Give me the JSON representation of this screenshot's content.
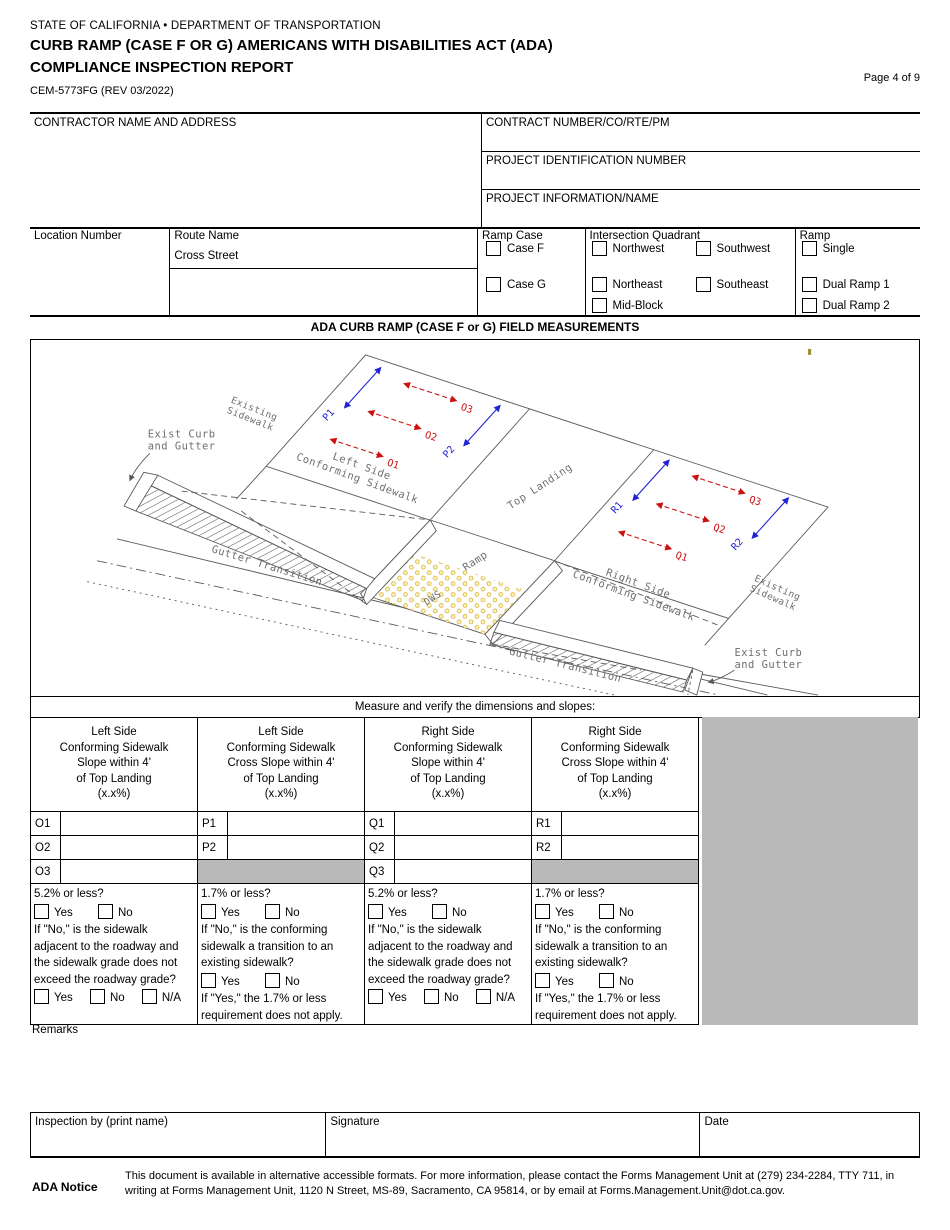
{
  "header": {
    "agency": "STATE OF CALIFORNIA • DEPARTMENT OF TRANSPORTATION",
    "title_line1": "CURB RAMP (CASE F OR G) AMERICANS WITH DISABILITIES ACT (ADA)",
    "title_line2": "COMPLIANCE INSPECTION REPORT",
    "form_number": "CEM-5773FG (REV 03/2022)",
    "page": "Page 4 of 9"
  },
  "info": {
    "contractor_label": "CONTRACTOR NAME AND ADDRESS",
    "contractor_value": "",
    "contract_label": "CONTRACT NUMBER/CO/RTE/PM",
    "contract_value": "",
    "project_id_label": "PROJECT IDENTIFICATION NUMBER",
    "project_id_value": "",
    "project_info_label": "PROJECT INFORMATION/NAME",
    "project_info_value": ""
  },
  "location": {
    "location_number_label": "Location Number",
    "route_name_label": "Route Name",
    "cross_street_label": "Cross Street",
    "ramp_case": {
      "label": "Ramp Case",
      "options": [
        {
          "label": "Case F",
          "checked": false
        },
        {
          "label": "Case G",
          "checked": false
        }
      ]
    },
    "quadrant": {
      "label": "Intersection Quadrant",
      "options": [
        {
          "label": "Northwest",
          "checked": false
        },
        {
          "label": "Southwest",
          "checked": false
        },
        {
          "label": "Northeast",
          "checked": false
        },
        {
          "label": "Southeast",
          "checked": false
        },
        {
          "label": "Mid-Block",
          "checked": false
        }
      ]
    },
    "ramp": {
      "label": "Ramp",
      "options": [
        {
          "label": "Single",
          "checked": false
        },
        {
          "label": "Dual Ramp 1",
          "checked": false
        },
        {
          "label": "Dual Ramp 2",
          "checked": false
        }
      ]
    }
  },
  "section_title": "ADA CURB RAMP (CASE F or G) FIELD MEASUREMENTS",
  "diagram": {
    "labels": {
      "existing_left_1": "Existing",
      "existing_left_2": "Sidewalk",
      "exist_curb_left_1": "Exist Curb",
      "exist_curb_left_2": "and Gutter",
      "left_side_1": "Left Side",
      "left_side_2": "Conforming Sidewalk",
      "top_landing": "Top Landing",
      "ramp": "Ramp",
      "dws": "DWS",
      "gutter_left": "Gutter Transition",
      "gutter_right": "Gutter Transition",
      "right_side_1": "Right Side",
      "right_side_2": "Conforming Sidewalk",
      "existing_right_1": "Existing",
      "existing_right_2": "Sidewalk",
      "exist_curb_right_1": "Exist Curb",
      "exist_curb_right_2": "and Gutter"
    },
    "measure_points": {
      "o1": "O1",
      "o2": "O2",
      "o3": "O3",
      "p1": "P1",
      "p2": "P2",
      "q1": "Q1",
      "q2": "Q2",
      "q3": "Q3",
      "r1": "R1",
      "r2": "R2"
    },
    "colors": {
      "slope_arrow": "#cc1111",
      "cross_arrow": "#2323d6",
      "dws_dot": "#d9b832",
      "line": "#5a5a5a"
    }
  },
  "measurements": {
    "instruction": "Measure and verify the dimensions and slopes:",
    "columns": [
      {
        "header_lines": [
          "Left Side",
          "Conforming Sidewalk",
          "Slope within 4'",
          "of Top Landing",
          "(x.x%)"
        ],
        "rows": [
          {
            "label": "O1",
            "value": ""
          },
          {
            "label": "O2",
            "value": ""
          },
          {
            "label": "O3",
            "value": ""
          }
        ]
      },
      {
        "header_lines": [
          "Left Side",
          "Conforming Sidewalk",
          "Cross Slope within 4'",
          "of Top Landing",
          "(x.x%)"
        ],
        "rows": [
          {
            "label": "P1",
            "value": ""
          },
          {
            "label": "P2",
            "value": ""
          }
        ]
      },
      {
        "header_lines": [
          "Right Side",
          "Conforming Sidewalk",
          "Slope within 4'",
          "of Top Landing",
          "(x.x%)"
        ],
        "rows": [
          {
            "label": "Q1",
            "value": ""
          },
          {
            "label": "Q2",
            "value": ""
          },
          {
            "label": "Q3",
            "value": ""
          }
        ]
      },
      {
        "header_lines": [
          "Right Side",
          "Conforming Sidewalk",
          "Cross Slope within 4'",
          "of Top Landing",
          "(x.x%)"
        ],
        "rows": [
          {
            "label": "R1",
            "value": ""
          },
          {
            "label": "R2",
            "value": ""
          }
        ]
      }
    ]
  },
  "questions": {
    "slope": {
      "q1": "5.2% or less?",
      "q2": "If \"No,\" is the sidewalk adjacent to the roadway and the sidewalk grade does not exceed the roadway grade?"
    },
    "cross": {
      "q1": "1.7% or less?",
      "q2": "If \"No,\" is the conforming sidewalk a transition to an existing sidewalk?",
      "note": "If \"Yes,\" the 1.7% or less requirement does not apply."
    },
    "yes": "Yes",
    "no": "No",
    "na": "N/A"
  },
  "remarks": {
    "label": "Remarks",
    "value": ""
  },
  "signature_row": {
    "inspection_label": "Inspection by (print name)",
    "inspection_value": "",
    "signature_label": "Signature",
    "signature_value": "",
    "date_label": "Date",
    "date_value": ""
  },
  "footer": {
    "ada_notice_label": "ADA Notice",
    "text": "This document is available in alternative accessible formats. For more information, please contact the Forms Management Unit at (279) 234-2284, TTY 711, in writing at Forms Management Unit, 1120 N Street, MS-89, Sacramento, CA 95814, or by email at Forms.Management.Unit@dot.ca.gov."
  }
}
